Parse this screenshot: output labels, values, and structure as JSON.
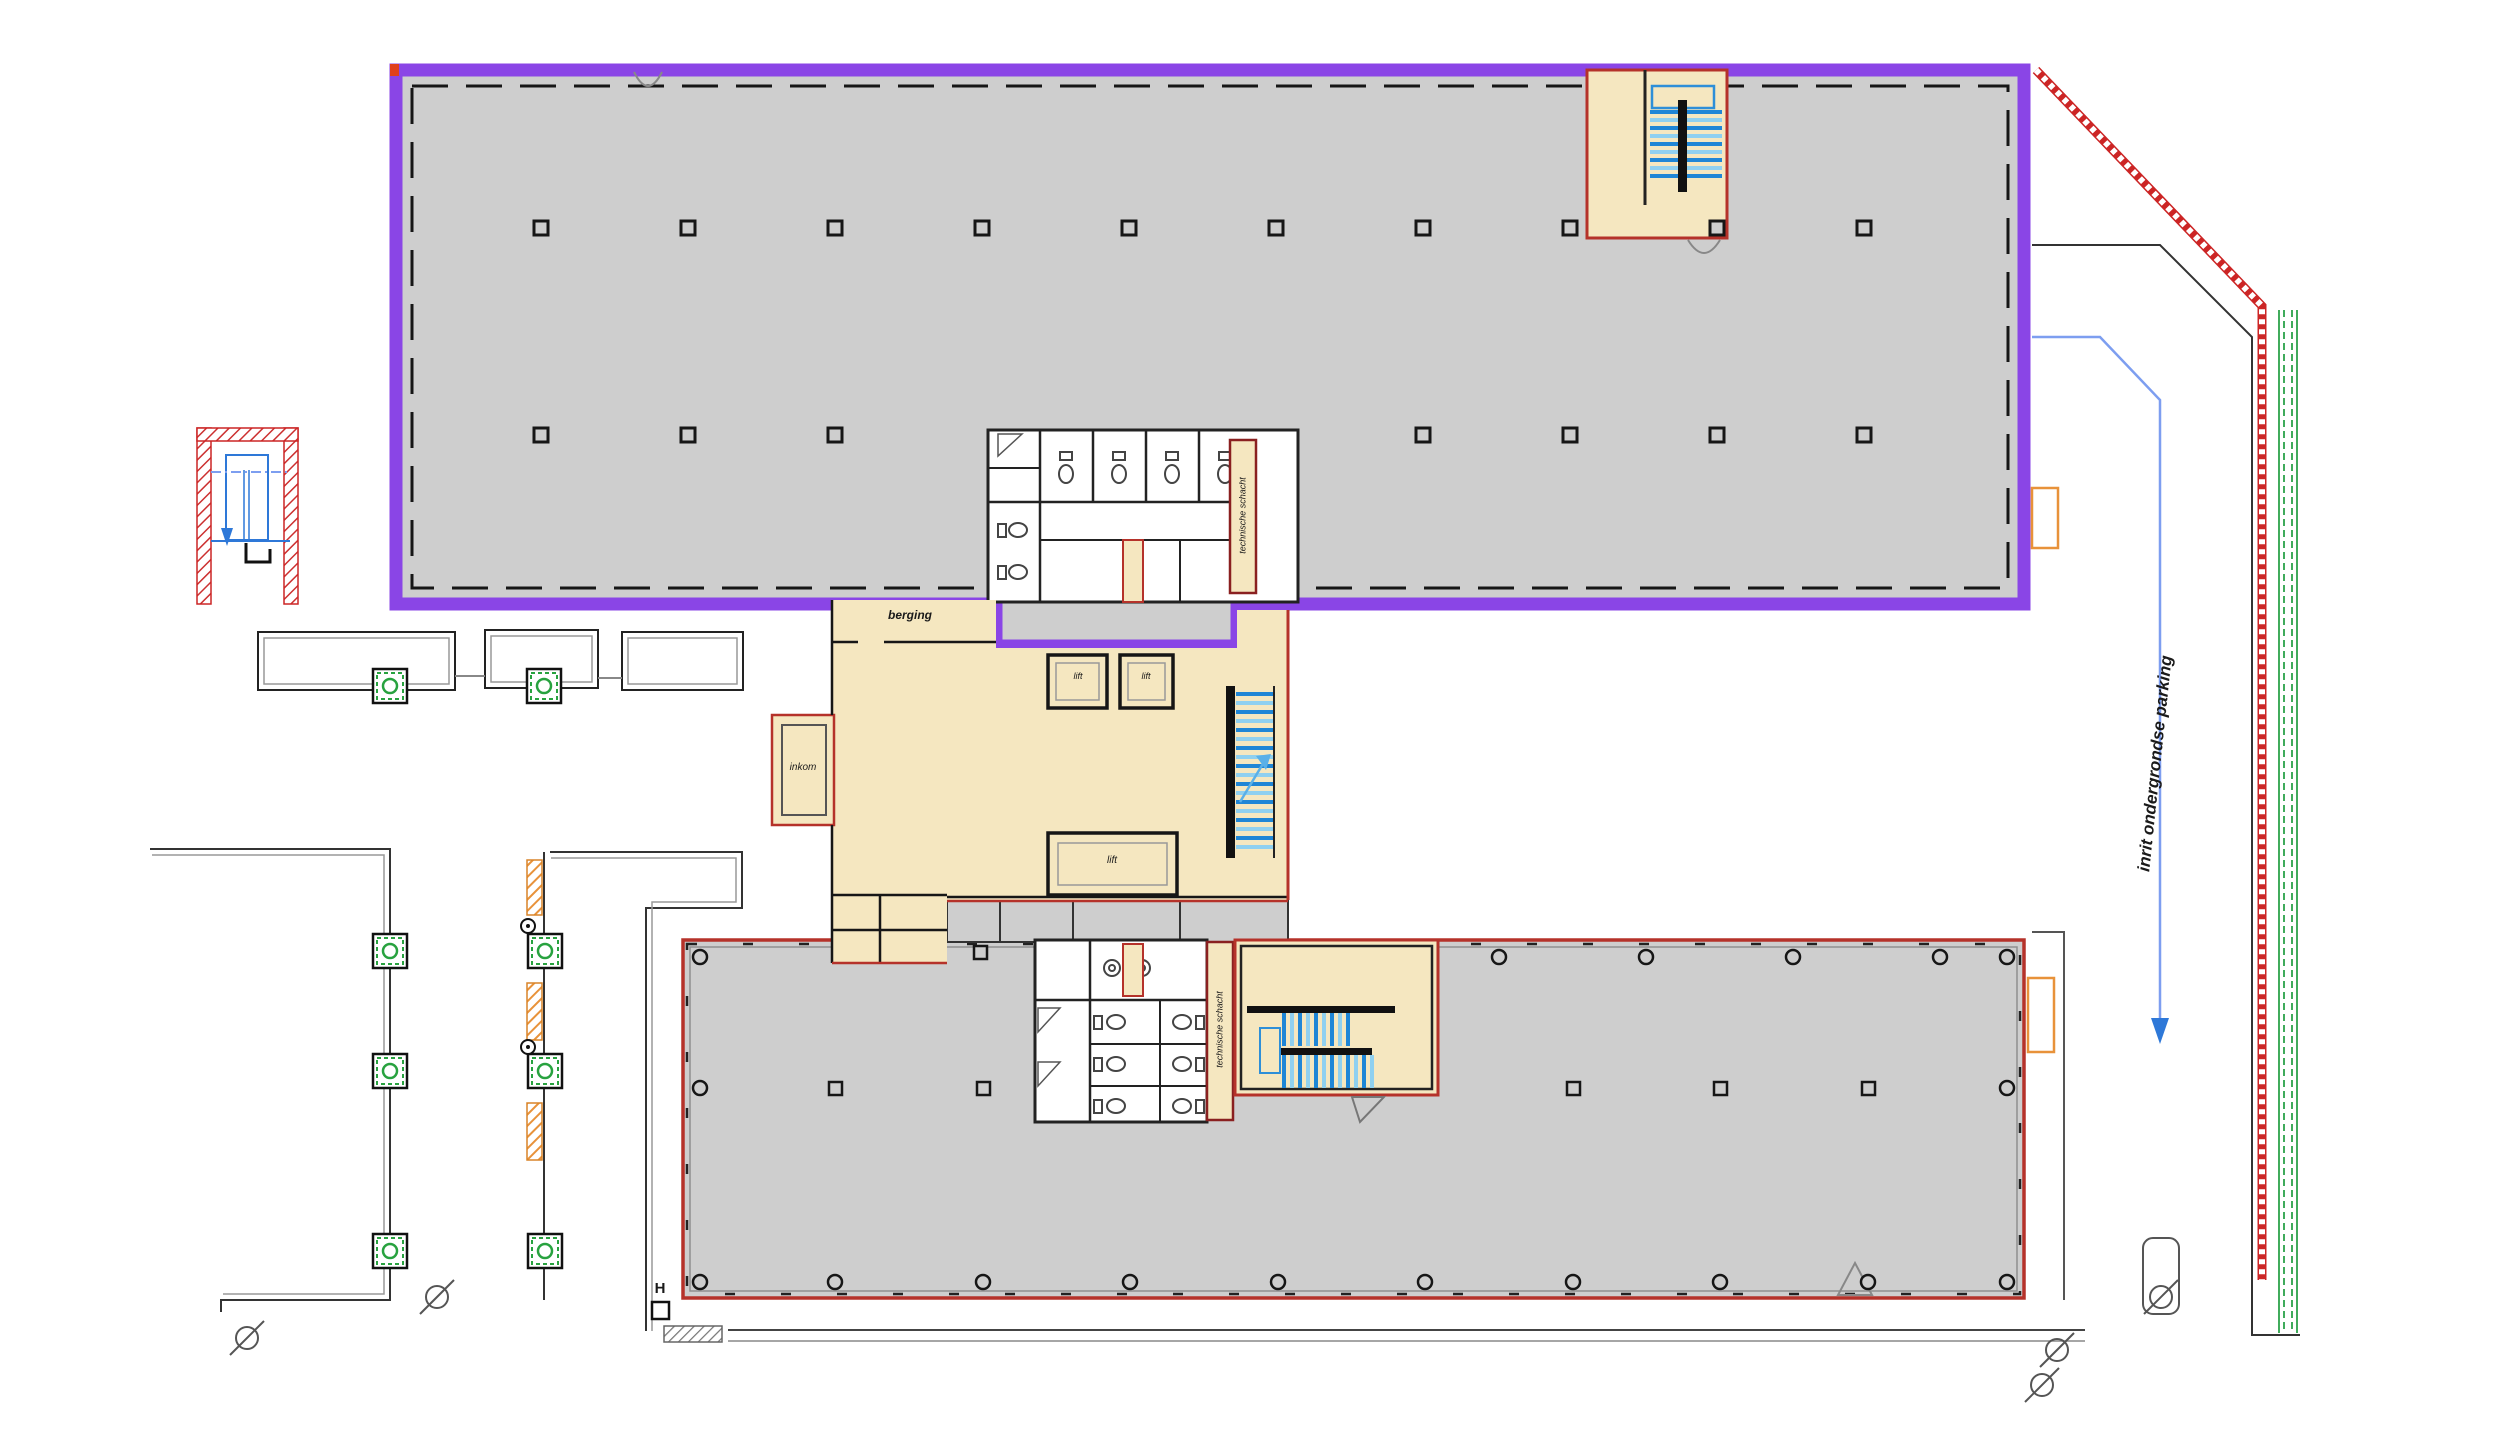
{
  "drawing": {
    "type": "architectural-floor-plan",
    "description": "Site / ground floor plan with upper office wing outlined purple, central entrance core, lower office wing outlined red, garden walkways and underground parking ramp"
  },
  "labels": {
    "storage": "berging",
    "lift": "lift",
    "entrance": "inkom",
    "technical_shaft": "technische schacht",
    "parking_ramp": "inrit ondergrondse parking",
    "hydrant": "H"
  },
  "colors": {
    "unit_purple": "#8a45e6",
    "building_red": "#b5322a",
    "hatch_red": "#cc2525",
    "room_cream": "#f5e7c0",
    "building_gray": "#cecece",
    "stair_blue": "#1f86d6",
    "stair_blue_light": "#8fd0f0",
    "ramp_blue": "#7d9ef0",
    "arrow_blue": "#2e78d8",
    "green": "#28a23f",
    "orange": "#e8923a",
    "wall_black": "#161616"
  },
  "plan": {
    "upper_building": {
      "square_columns": [
        [
          541,
          228
        ],
        [
          688,
          228
        ],
        [
          835,
          228
        ],
        [
          982,
          228
        ],
        [
          1129,
          228
        ],
        [
          1276,
          228
        ],
        [
          1423,
          228
        ],
        [
          1570,
          228
        ],
        [
          1717,
          228
        ],
        [
          1864,
          228
        ],
        [
          541,
          435
        ],
        [
          688,
          435
        ],
        [
          835,
          435
        ],
        [
          1423,
          435
        ],
        [
          1570,
          435
        ],
        [
          1717,
          435
        ],
        [
          1864,
          435
        ]
      ]
    },
    "lower_building": {
      "square_columns": [
        [
          835,
          1088
        ],
        [
          983,
          1088
        ],
        [
          1573,
          1088
        ],
        [
          1720,
          1088
        ],
        [
          1868,
          1088
        ],
        [
          980,
          952
        ]
      ],
      "circle_columns": [
        [
          700,
          957
        ],
        [
          700,
          1088
        ],
        [
          700,
          1282
        ],
        [
          2007,
          957
        ],
        [
          2007,
          1088
        ],
        [
          2007,
          1282
        ],
        [
          1499,
          957
        ],
        [
          1646,
          957
        ],
        [
          1793,
          957
        ],
        [
          1940,
          957
        ],
        [
          835,
          1282
        ],
        [
          983,
          1282
        ],
        [
          1130,
          1282
        ],
        [
          1278,
          1282
        ],
        [
          1425,
          1282
        ],
        [
          1573,
          1282
        ],
        [
          1720,
          1282
        ],
        [
          1868,
          1282
        ]
      ]
    },
    "site": {
      "tree_planters": [
        [
          390,
          686
        ],
        [
          544,
          686
        ],
        [
          390,
          951
        ],
        [
          390,
          1071
        ],
        [
          390,
          1251
        ],
        [
          545,
          951
        ],
        [
          545,
          1071
        ],
        [
          545,
          1251
        ]
      ],
      "orange_hatches": [
        [
          527,
          860,
          15,
          55
        ],
        [
          527,
          983,
          15,
          57
        ],
        [
          527,
          1103,
          15,
          57
        ]
      ],
      "survey_markers": [
        [
          528,
          926
        ],
        [
          528,
          1047
        ]
      ],
      "diameter_symbols": [
        [
          247,
          1338
        ],
        [
          437,
          1297
        ],
        [
          2057,
          1350
        ],
        [
          2042,
          1385
        ],
        [
          2161,
          1297
        ]
      ]
    }
  }
}
